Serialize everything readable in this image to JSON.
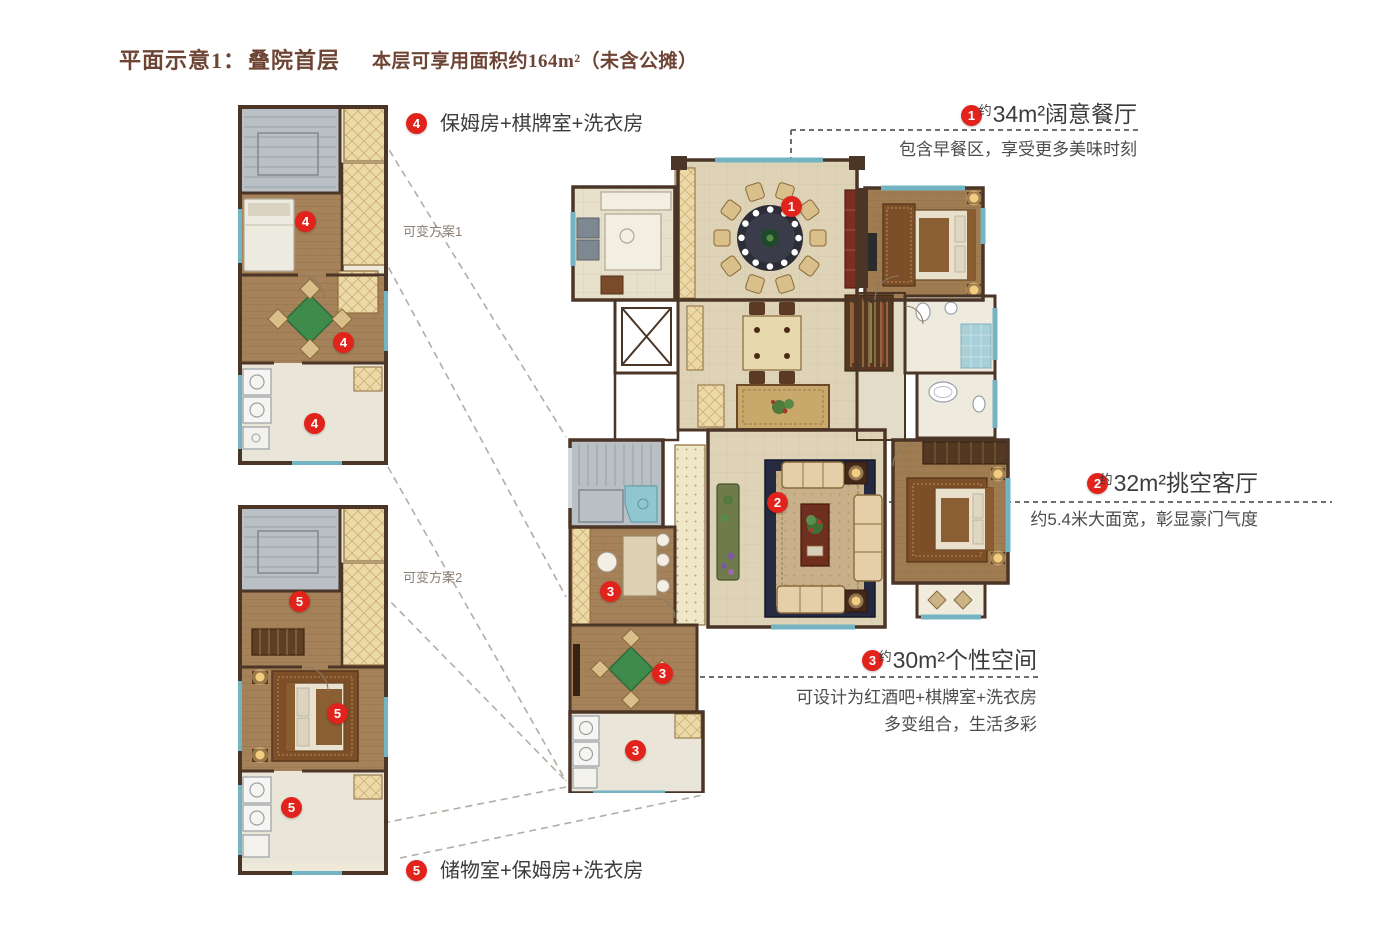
{
  "title": {
    "prefix": "平面示意1：",
    "name": "叠院首层",
    "area_note": "本层可享用面积约164m²（未含公摊）"
  },
  "annotations": {
    "a1": {
      "num": "1",
      "approx": "约",
      "headline": "34m²阔意餐厅",
      "desc": "包含早餐区，享受更多美味时刻"
    },
    "a2": {
      "num": "2",
      "approx": "约",
      "headline": "32m²挑空客厅",
      "desc": "约5.4米大面宽，彰显豪门气度"
    },
    "a3": {
      "num": "3",
      "approx": "约",
      "headline": "30m²个性空间",
      "desc1": "可设计为红酒吧+棋牌室+洗衣房",
      "desc2": "多变组合，生活多彩"
    },
    "a4": {
      "num": "4",
      "text": "保姆房+棋牌室+洗衣房"
    },
    "a5": {
      "num": "5",
      "text": "储物室+保姆房+洗衣房"
    }
  },
  "variants": {
    "v1": "可变方案1",
    "v2": "可变方案2"
  },
  "colors": {
    "accent_red": "#e2231c",
    "title_brown": "#6e4434",
    "wall_brown": "#4a3526",
    "window_teal": "#74b3c2",
    "table_green": "#3e8b4b",
    "wood_floor": "#a07c52",
    "cream_floor": "#ded3b6"
  }
}
